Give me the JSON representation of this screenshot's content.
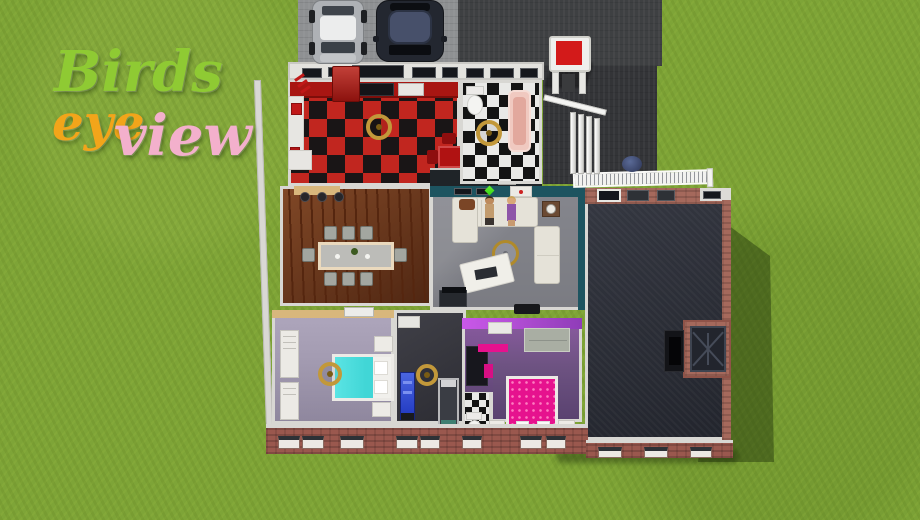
{
  "title": {
    "word_birds": "Birds",
    "word_eye": "eye",
    "word_view": "view"
  },
  "colors": {
    "grass": "#7ea437",
    "driveway": "#8e9092",
    "road": "#3e4042",
    "patio": "#333437",
    "wall": "#d8d7d3",
    "brick": "#a5695c",
    "brick_dark": "#9a584e",
    "kitchen_red": "#c1261f",
    "kitchen_black": "#191516",
    "tile_white": "#e9e9e7",
    "tile_black": "#141414",
    "wood": "#6b3419",
    "wood_dark": "#55260f",
    "living_floor": "#85868d",
    "teal": "#1d5460",
    "big_floor": "#2a2d37",
    "bed1_wall": "#d8b77c",
    "bed1_floor": "#a49cb2",
    "gym_floor": "#34343c",
    "bed2_wall": "#b44fd6",
    "bed2_floor": "#6e5382",
    "pink": "#e6128e",
    "cyan": "#41d6d6",
    "red": "#d31a1a",
    "gold": "#c2983a",
    "sofa": "#e5e2d8",
    "car_silver": "#aeb1b5",
    "car_navy": "#232730",
    "plumbob": "#35d414",
    "title_green": "#8fca33",
    "title_orange": "#f2a51a",
    "title_pink": "#f3b0cc",
    "shadow": "rgba(24,40,8,0.42)"
  }
}
